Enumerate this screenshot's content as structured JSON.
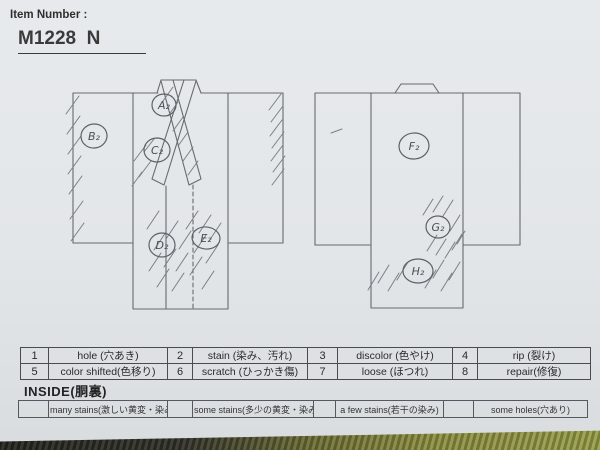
{
  "header": {
    "label": "Item Number :",
    "value": "M1228  N"
  },
  "diagram": {
    "front": {
      "marks": [
        {
          "text": "A₂"
        },
        {
          "text": "B₂"
        },
        {
          "text": "C₂"
        },
        {
          "text": "D₂"
        },
        {
          "text": "E₂"
        }
      ]
    },
    "back": {
      "marks": [
        {
          "text": "F₂"
        },
        {
          "text": "G₂"
        },
        {
          "text": "H₂"
        }
      ]
    }
  },
  "legend": {
    "rows": [
      [
        {
          "code": "1",
          "label": "hole (穴あき)"
        },
        {
          "code": "2",
          "label": "stain (染み、汚れ)"
        },
        {
          "code": "3",
          "label": "discolor (色やけ)"
        },
        {
          "code": "4",
          "label": "rip (裂け)"
        }
      ],
      [
        {
          "code": "5",
          "label": "color shifted(色移り)"
        },
        {
          "code": "6",
          "label": "scratch (ひっかき傷)"
        },
        {
          "code": "7",
          "label": "loose (ほつれ)"
        },
        {
          "code": "8",
          "label": "repair(修復)"
        }
      ]
    ]
  },
  "inside": {
    "heading": "INSIDE(胴裏)",
    "options": [
      {
        "label": "many stains(激しい黄変・染み)"
      },
      {
        "label": "some stains(多少の黄変・染み)"
      },
      {
        "label": "a few stains(若干の染み)"
      },
      {
        "label": "some holes(穴あり)"
      }
    ]
  },
  "colors": {
    "paper": "#e3e6e9",
    "ink": "#2f2f2f",
    "pencil": "#686d74",
    "tatami_dark": "#2e2e29",
    "tatami_green": "#99a04b"
  }
}
